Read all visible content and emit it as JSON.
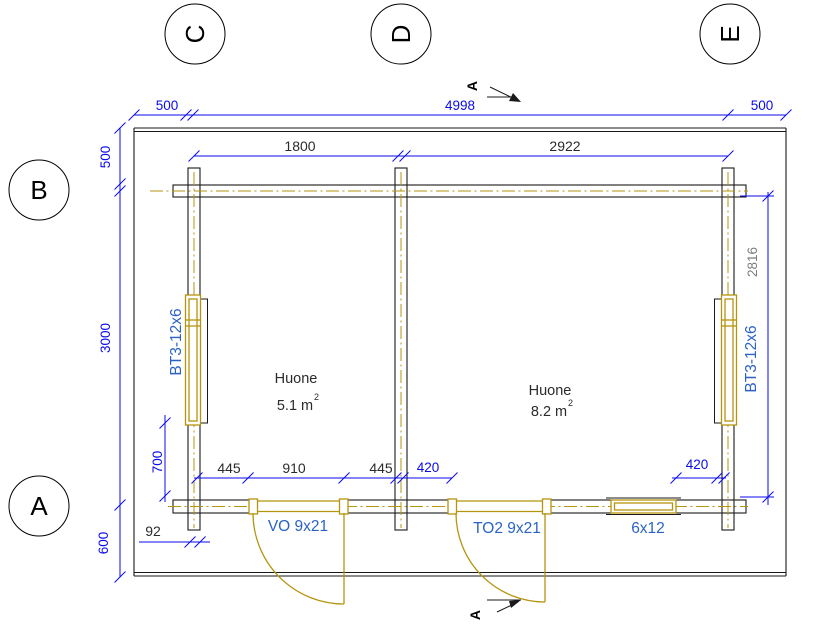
{
  "colors": {
    "dim_blue": "#0A0AEF",
    "label_blue": "#2B62C6",
    "gold": "#B5940F",
    "line_black": "#1A1A1A",
    "text_dark": "#2B2B2B",
    "text_grey": "#7C7C7C"
  },
  "grid": {
    "top": [
      "C",
      "D",
      "E"
    ],
    "left": [
      "B",
      "A"
    ]
  },
  "section": {
    "label": "A"
  },
  "dims": {
    "top_left": "500",
    "top_span": "4998",
    "top_right": "500",
    "room1_width": "1800",
    "room2_width": "2922",
    "left_top": "500",
    "left_span": "3000",
    "left_bottom": "600",
    "right_inner_height": "2816",
    "chain_left": "445",
    "chain_mid": "910",
    "chain_right": "445",
    "door2_offset": "420",
    "window_offset": "420",
    "wall_thickness": "92",
    "window_sill": "700"
  },
  "rooms": [
    {
      "name": "Huone",
      "area": "5.1 m",
      "area_sup": "2"
    },
    {
      "name": "Huone",
      "area": "8.2 m",
      "area_sup": "2"
    }
  ],
  "fixtures": {
    "window_left": "BT3-12x6",
    "window_right": "BT3-12x6",
    "door_left": "VO 9x21",
    "door_mid": "TO2 9x21",
    "window_bottom": "6x12"
  }
}
